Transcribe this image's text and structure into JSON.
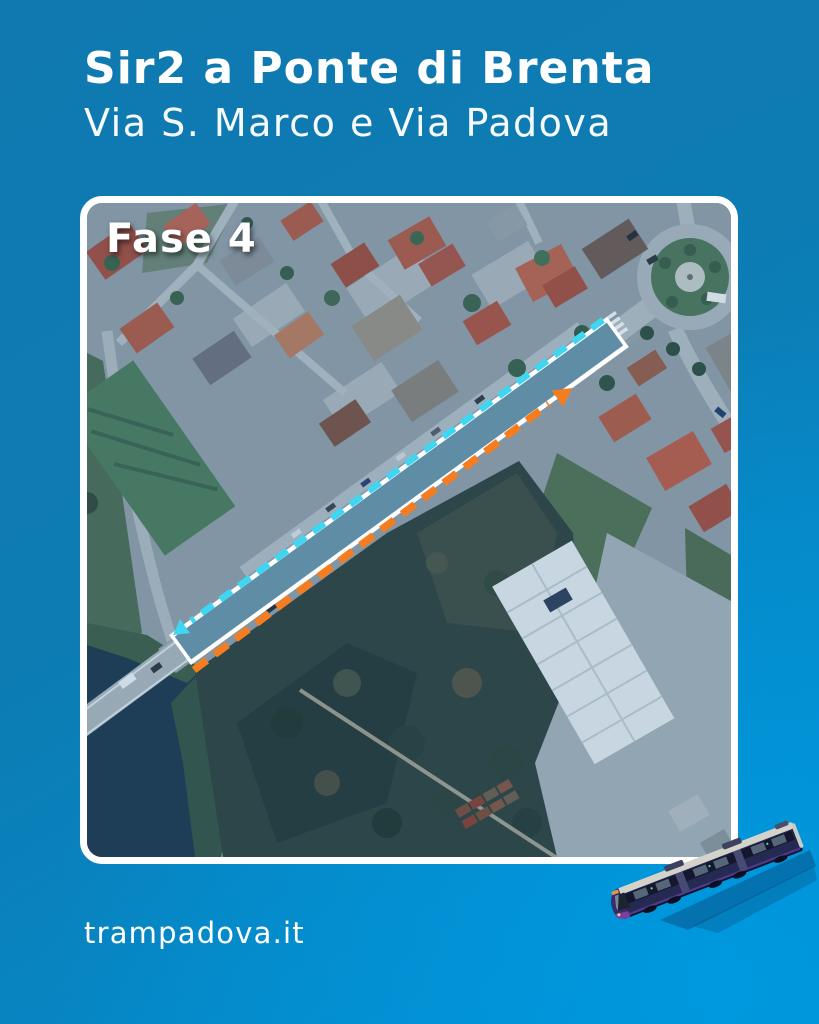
{
  "header": {
    "title": "Sir2 a Ponte di Brenta",
    "subtitle": "Via S. Marco e Via Padova"
  },
  "map": {
    "phase_label": "Fase 4",
    "overlay": {
      "route_band_color": "#4a7e99",
      "arrows": [
        {
          "id": "cyan-arrow",
          "color": "#3fd6f2",
          "style": "dashed",
          "direction": "toward lower-left"
        },
        {
          "id": "orange-arrow",
          "color": "#f57d1f",
          "style": "dashed",
          "direction": "toward upper-right"
        }
      ]
    }
  },
  "footer": {
    "site": "trampadova.it"
  },
  "theme": {
    "bg_top_left": "#0f79b0",
    "bg_bottom_right": "#0098de",
    "route_band": "#4a7e99",
    "arrow_cyan": "#3fd6f2",
    "arrow_orange": "#f57d1f",
    "text": "#ffffff"
  }
}
